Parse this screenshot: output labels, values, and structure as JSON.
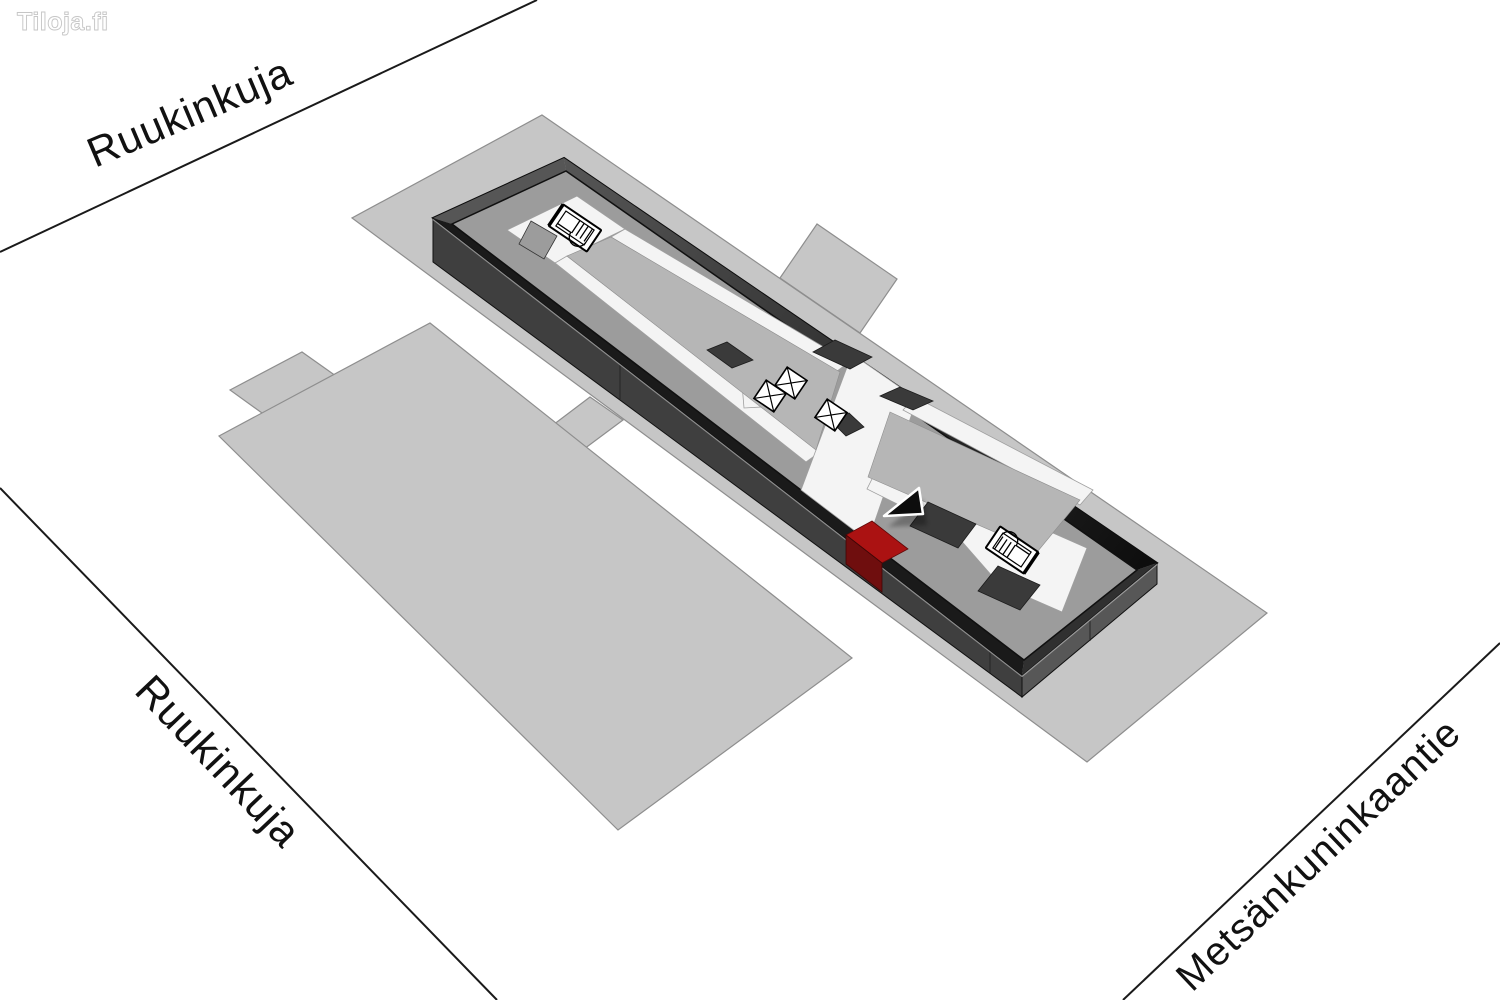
{
  "logo": {
    "text": "Tiloja.fi"
  },
  "streets": {
    "top": {
      "name": "Ruukinkuja"
    },
    "bottom_left": {
      "name": "Ruukinkuja"
    },
    "bottom_right": {
      "name": "Metsänkuninkaantie"
    }
  },
  "map": {
    "view": "3d-site-plan",
    "highlighted_unit_count": 1
  },
  "icons": [
    {
      "name": "stairs-icon",
      "count": 2
    },
    {
      "name": "elevator-icon",
      "count": 3
    },
    {
      "name": "location-arrow-icon",
      "count": 1
    }
  ],
  "colors": {
    "background": "#ffffff",
    "street_line": "#1a1a1a",
    "label_text": "#111111",
    "parcel": "#c6c6c6",
    "roof": "#9c9c9c",
    "roof_rim": "#1a1a1a",
    "corridor": "#f4f4f4",
    "island": "#b6b6b6",
    "dark_unit": "#3a3a3a",
    "building_side": "#3f3f3f",
    "building_end": "#575757",
    "highlight": "#ab1212",
    "highlight_dark": "#6f0e0e"
  }
}
